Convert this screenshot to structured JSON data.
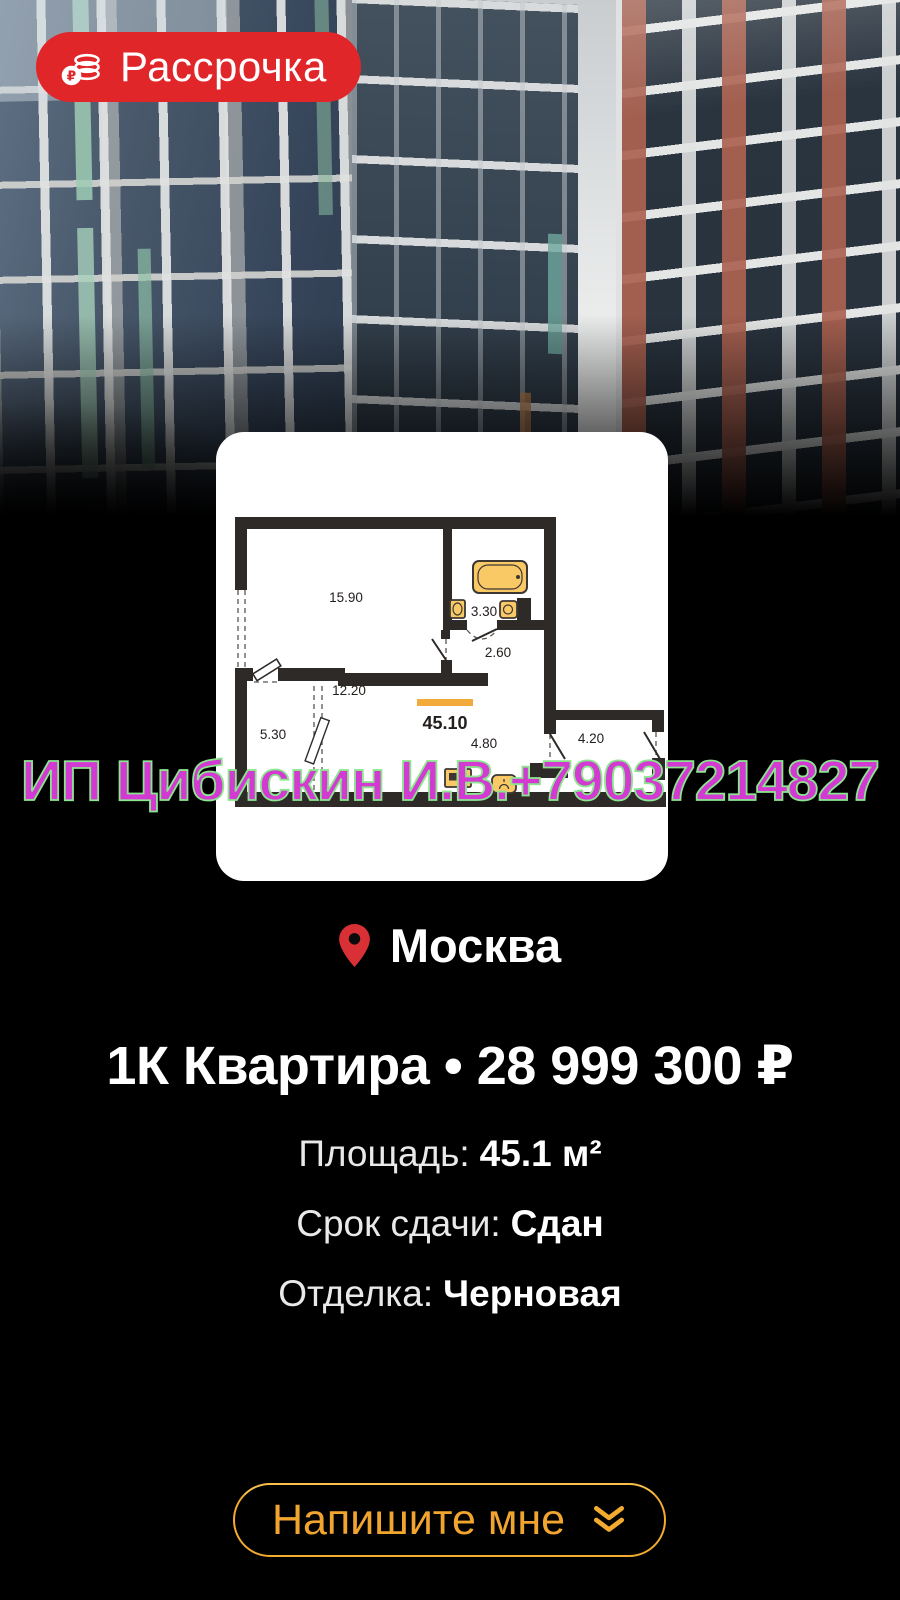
{
  "badge": {
    "label": "Рассрочка"
  },
  "floorplan": {
    "total_area_label": "45.10",
    "rooms": [
      {
        "name": "living-room",
        "area": "15.90"
      },
      {
        "name": "bathroom",
        "area": "3.30"
      },
      {
        "name": "hallway",
        "area": "2.60"
      },
      {
        "name": "kitchen-living",
        "area": "12.20"
      },
      {
        "name": "kitchen-zone",
        "area": "4.80"
      },
      {
        "name": "storage-room",
        "area": "4.20"
      },
      {
        "name": "balcony",
        "area": "5.30"
      }
    ]
  },
  "location": {
    "city": "Москва"
  },
  "listing": {
    "title": "1К Квартира • 28 999 300 ₽"
  },
  "details": [
    {
      "label": "Площадь:",
      "value": "45.1 м²"
    },
    {
      "label": "Срок сдачи:",
      "value": "Сдан"
    },
    {
      "label": "Отделка:",
      "value": "Черновая"
    }
  ],
  "watermark": "ИП Цибискин И.В.+79037214827",
  "cta": {
    "label": "Напишите мне"
  },
  "colors": {
    "badge_red": "#e12629",
    "accent_gold": "#f3ab2f",
    "watermark_magenta": "#d23ad2",
    "pin_red": "#d93036",
    "fixture_orange": "#f9c966"
  }
}
